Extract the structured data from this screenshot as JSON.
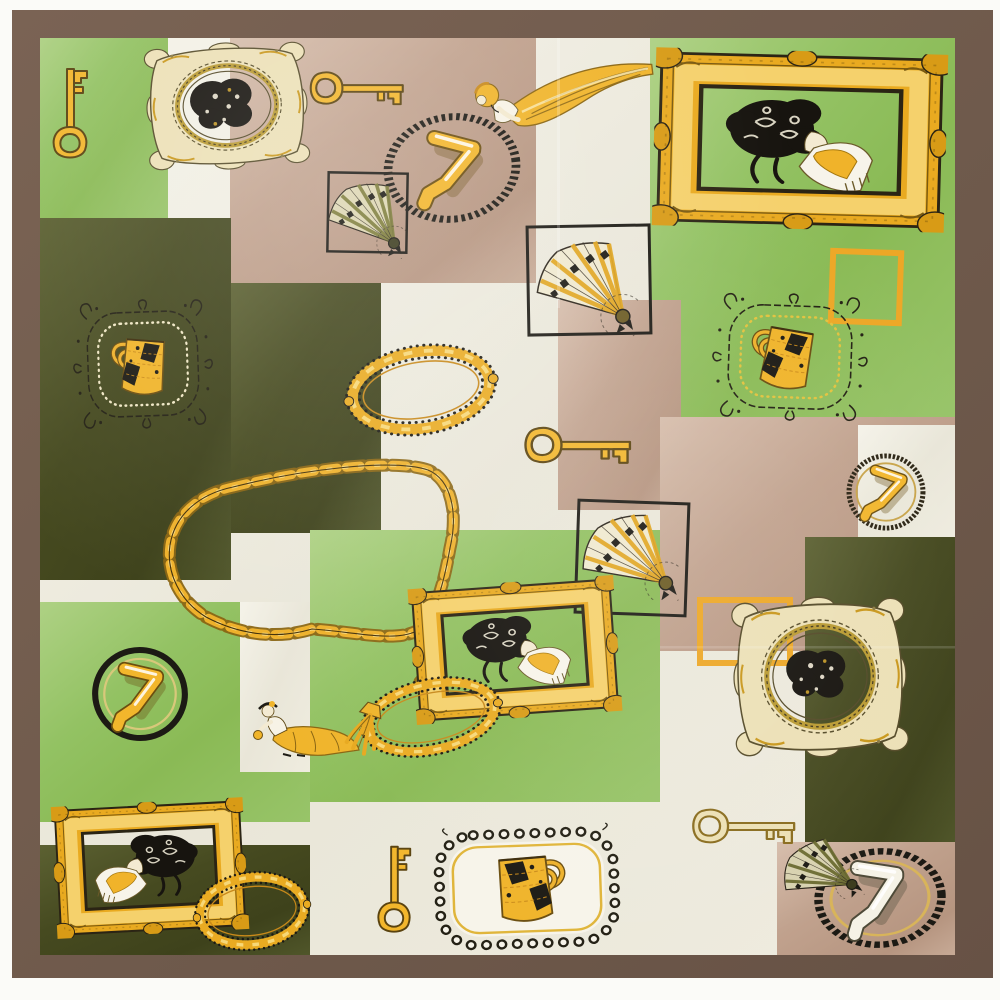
{
  "meta": {
    "description": "Product photo of a square silk satin scarf printed with gilded picture frames, antique keys, handbags, folding fans and Art Nouveau ladies on a patchwork of green, olive, tan and cream blocks, hemmed with a brown border"
  },
  "palette": {
    "photo_bg": "#fbfbf8",
    "hem_brown": "#6e594b",
    "hem_brown_light": "#7a6354",
    "hem_brown_dark": "#675245",
    "green": "#93c263",
    "olive": "#464a20",
    "tan": "#c1a28e",
    "cream": "#e9e6d8",
    "gold": "#f0b42a",
    "gold_deep": "#c8891a",
    "gold_pale": "#ece0b5",
    "ink": "#1c1a14"
  },
  "scarf": {
    "border": {
      "x": 12,
      "y": 10,
      "w": 981,
      "h": 968
    },
    "print": {
      "x": 40,
      "y": 38,
      "w": 915,
      "h": 917
    }
  },
  "blocks": [
    {
      "name": "green-top-left",
      "c": "green",
      "x": 40,
      "y": 38,
      "w": 128,
      "h": 180
    },
    {
      "name": "tan-top",
      "c": "tan",
      "x": 230,
      "y": 38,
      "w": 306,
      "h": 245
    },
    {
      "name": "green-top-right",
      "c": "green",
      "x": 650,
      "y": 38,
      "w": 305,
      "h": 380
    },
    {
      "name": "olive-left-a",
      "c": "olive",
      "x": 40,
      "y": 218,
      "w": 191,
      "h": 362
    },
    {
      "name": "olive-left-b",
      "c": "olive",
      "x": 231,
      "y": 283,
      "w": 150,
      "h": 250
    },
    {
      "name": "tan-mid-column",
      "c": "tan",
      "x": 558,
      "y": 300,
      "w": 123,
      "h": 210
    },
    {
      "name": "green-center",
      "c": "green",
      "x": 310,
      "y": 530,
      "w": 350,
      "h": 272
    },
    {
      "name": "tan-right",
      "c": "tan",
      "x": 660,
      "y": 417,
      "w": 295,
      "h": 234
    },
    {
      "name": "cream-right-block",
      "c": "cream",
      "x": 858,
      "y": 425,
      "w": 97,
      "h": 112
    },
    {
      "name": "olive-right",
      "c": "olive",
      "x": 805,
      "y": 537,
      "w": 150,
      "h": 305
    },
    {
      "name": "green-left-bottom",
      "c": "green",
      "x": 40,
      "y": 602,
      "w": 270,
      "h": 220
    },
    {
      "name": "cream-column-bottom-left",
      "c": "cream",
      "x": 240,
      "y": 602,
      "w": 70,
      "h": 170
    },
    {
      "name": "olive-bottom-left",
      "c": "olive",
      "x": 40,
      "y": 845,
      "w": 270,
      "h": 110
    },
    {
      "name": "tan-bottom-right",
      "c": "tan",
      "x": 777,
      "y": 842,
      "w": 178,
      "h": 113
    }
  ],
  "motifs": [
    {
      "type": "square",
      "name": "gold-square-outline-top-right",
      "x": 832,
      "y": 252,
      "w": 68,
      "h": 70,
      "rot": 2,
      "stroke": "#eda726",
      "sw": 6
    },
    {
      "type": "square",
      "name": "gold-square-outline-mid-right",
      "x": 700,
      "y": 600,
      "w": 90,
      "h": 63,
      "rot": 0,
      "stroke": "#eda726",
      "sw": 6
    },
    {
      "type": "chain",
      "name": "ornate-gold-chain",
      "d": "M233,487 C300,470 392,458 428,470 C452,480 458,514 450,548 C444,582 438,604 424,626 C404,645 358,632 312,629 C276,640 238,634 206,617 C180,601 166,573 170,545 C175,514 200,494 233,487 Z"
    },
    {
      "type": "chain",
      "name": "chain-drop",
      "d": "M424,626 C438,644 438,664 420,682"
    },
    {
      "type": "ring",
      "name": "stitched-circle-top",
      "cx": 452,
      "cy": 168,
      "w": 146,
      "h": 116,
      "rot": -8,
      "vars": "--ro:#1c1a14;--rd:2.5 2.5;--ri:transparent"
    },
    {
      "type": "legs",
      "name": "legs-in-circle-top",
      "cx": 452,
      "cy": 170,
      "w": 74,
      "h": 92,
      "rot": 6
    },
    {
      "type": "ring",
      "name": "circle-bottom-left",
      "cx": 140,
      "cy": 694,
      "w": 102,
      "h": 100,
      "rot": 8,
      "vars": "--ro:#1c1a14;--ri:#d8c87a"
    },
    {
      "type": "legs",
      "name": "legs-in-circle-bottom-left",
      "cx": 140,
      "cy": 696,
      "w": 62,
      "h": 80,
      "rot": 4
    },
    {
      "type": "ring",
      "name": "circle-right-mid",
      "cx": 886,
      "cy": 492,
      "w": 84,
      "h": 82,
      "rot": 0,
      "vars": "--ro:#2b2414;--rd:3 2;--ri:#c8a44a"
    },
    {
      "type": "legs",
      "name": "legs-in-circle-right",
      "cx": 886,
      "cy": 494,
      "w": 52,
      "h": 66,
      "rot": 10
    },
    {
      "type": "square",
      "name": "fan-frame-small",
      "x": 328,
      "y": 173,
      "w": 79,
      "h": 79,
      "rot": 1,
      "stroke": "#1c1a14",
      "sw": 2.5
    },
    {
      "type": "fan",
      "name": "fan-small-top",
      "cx": 367,
      "cy": 216,
      "w": 86,
      "h": 70,
      "rot": 12,
      "vars": "--fp:#ddd6b2;--fr:#7a7a36;--fv:#3c3c1e"
    },
    {
      "type": "square",
      "name": "fan-frame-large",
      "x": 528,
      "y": 226,
      "w": 122,
      "h": 108,
      "rot": -1,
      "stroke": "#1c1a14",
      "sw": 3
    },
    {
      "type": "fan",
      "name": "fan-large-top",
      "cx": 586,
      "cy": 284,
      "w": 110,
      "h": 90,
      "rot": 8
    },
    {
      "type": "square",
      "name": "fan-frame-mid",
      "x": 577,
      "y": 502,
      "w": 110,
      "h": 112,
      "rot": 2,
      "stroke": "#1c1a14",
      "sw": 3
    },
    {
      "type": "fan",
      "name": "fan-mid",
      "cx": 628,
      "cy": 556,
      "w": 104,
      "h": 86,
      "rot": 2
    },
    {
      "type": "key",
      "name": "key-top-left",
      "cx": 70,
      "cy": 113,
      "w": 44,
      "h": 100,
      "rot": 0
    },
    {
      "type": "key",
      "name": "key-top-center",
      "cx": 357,
      "cy": 88,
      "w": 42,
      "h": 104,
      "rot": 90
    },
    {
      "type": "key",
      "name": "key-center",
      "cx": 578,
      "cy": 445,
      "w": 46,
      "h": 118,
      "rot": 90
    },
    {
      "type": "key",
      "name": "key-bottom-center",
      "cx": 394,
      "cy": 889,
      "w": 42,
      "h": 96,
      "rot": 0
    },
    {
      "type": "key",
      "name": "key-bottom-right",
      "cx": 744,
      "cy": 826,
      "w": 44,
      "h": 114,
      "rot": 90,
      "vars": "--kf:#ece0b5;--ko:#8a6d1f"
    },
    {
      "type": "vine-frame",
      "name": "vine-frame-left",
      "cx": 143,
      "cy": 364,
      "w": 142,
      "h": 130,
      "rot": -2,
      "vars": "--vd:#efe6c4"
    },
    {
      "type": "handbag",
      "name": "handbag-left",
      "cx": 146,
      "cy": 366,
      "w": 74,
      "h": 74,
      "rot": -3,
      "flip": true
    },
    {
      "type": "vine-frame",
      "name": "vine-frame-right",
      "cx": 790,
      "cy": 357,
      "w": 158,
      "h": 128,
      "rot": 2,
      "vars": "--vd:#e2c23e"
    },
    {
      "type": "handbag",
      "name": "handbag-right",
      "cx": 790,
      "cy": 358,
      "w": 84,
      "h": 80,
      "rot": 3,
      "flip": true
    },
    {
      "type": "scallop-frame",
      "name": "scallop-frame-bottom",
      "cx": 527,
      "cy": 888,
      "w": 206,
      "h": 126,
      "rot": -2
    },
    {
      "type": "handbag",
      "name": "handbag-bottom",
      "cx": 522,
      "cy": 888,
      "w": 92,
      "h": 86,
      "rot": 2
    },
    {
      "type": "lady-leaning",
      "name": "lady-leaning-top",
      "cx": 560,
      "cy": 92,
      "w": 192,
      "h": 96,
      "rot": -1
    },
    {
      "type": "lady-walking",
      "name": "lady-walking-center",
      "cx": 308,
      "cy": 728,
      "w": 110,
      "h": 60,
      "rot": 0
    },
    {
      "type": "beaded-oval",
      "name": "oval-frame-center",
      "cx": 421,
      "cy": 390,
      "w": 158,
      "h": 96,
      "rot": -9
    },
    {
      "type": "hatblob",
      "name": "hat-silhouette-top-left",
      "cx": 224,
      "cy": 104,
      "w": 82,
      "h": 64,
      "rot": -4
    },
    {
      "type": "rococo-frame",
      "name": "rococo-frame-top-left",
      "cx": 227,
      "cy": 106,
      "w": 162,
      "h": 128,
      "rot": -3
    },
    {
      "type": "portrait",
      "name": "portrait-top-right",
      "cx": 797,
      "cy": 142,
      "w": 168,
      "h": 104,
      "rot": 1
    },
    {
      "type": "gold-frame",
      "name": "gold-frame-top-right",
      "cx": 800,
      "cy": 140,
      "w": 292,
      "h": 178,
      "rot": 1.5
    },
    {
      "type": "portrait",
      "name": "portrait-center",
      "cx": 515,
      "cy": 649,
      "w": 122,
      "h": 80,
      "rot": -3
    },
    {
      "type": "gold-frame",
      "name": "gold-frame-center",
      "cx": 515,
      "cy": 650,
      "w": 206,
      "h": 136,
      "rot": -4
    },
    {
      "type": "portrait",
      "name": "portrait-bottom-left",
      "cx": 148,
      "cy": 866,
      "w": 118,
      "h": 76,
      "rot": -2,
      "flip": true
    },
    {
      "type": "gold-frame",
      "name": "gold-frame-bottom-left",
      "cx": 150,
      "cy": 868,
      "w": 192,
      "h": 132,
      "rot": -3
    },
    {
      "type": "hatblob",
      "name": "hat-silhouette-bottom-right",
      "cx": 818,
      "cy": 674,
      "w": 78,
      "h": 62,
      "rot": 3
    },
    {
      "type": "rococo-frame",
      "name": "rococo-frame-bottom-right",
      "cx": 820,
      "cy": 677,
      "w": 174,
      "h": 162,
      "rot": -2
    },
    {
      "type": "beaded-oval",
      "name": "oval-frame-lower-center",
      "cx": 431,
      "cy": 717,
      "w": 148,
      "h": 82,
      "rot": -12
    },
    {
      "type": "tassel",
      "name": "chain-tassel",
      "cx": 366,
      "cy": 728,
      "w": 40,
      "h": 58,
      "rot": 18
    },
    {
      "type": "beaded-oval",
      "name": "oval-frame-olive",
      "cx": 252,
      "cy": 911,
      "w": 120,
      "h": 84,
      "rot": -7
    },
    {
      "type": "ring",
      "name": "oval-ring-bottom-right",
      "cx": 880,
      "cy": 898,
      "w": 140,
      "h": 106,
      "rot": -4,
      "vars": "--ro:#1c1a14;--rd:4 2.5;--ri:#d8b45a"
    },
    {
      "type": "legs",
      "name": "legs-bottom-right",
      "cx": 878,
      "cy": 898,
      "w": 72,
      "h": 92,
      "rot": 0,
      "vars": "--lf:#f5f2e6;--lo:#4e4a38;--lh:#ffffff"
    },
    {
      "type": "fan",
      "name": "fan-bottom-right",
      "cx": 818,
      "cy": 872,
      "w": 82,
      "h": 64,
      "rot": -12,
      "vars": "--fp:#d8d2b0;--fr:#6a6a30;--fv:#3c3c1e"
    }
  ]
}
